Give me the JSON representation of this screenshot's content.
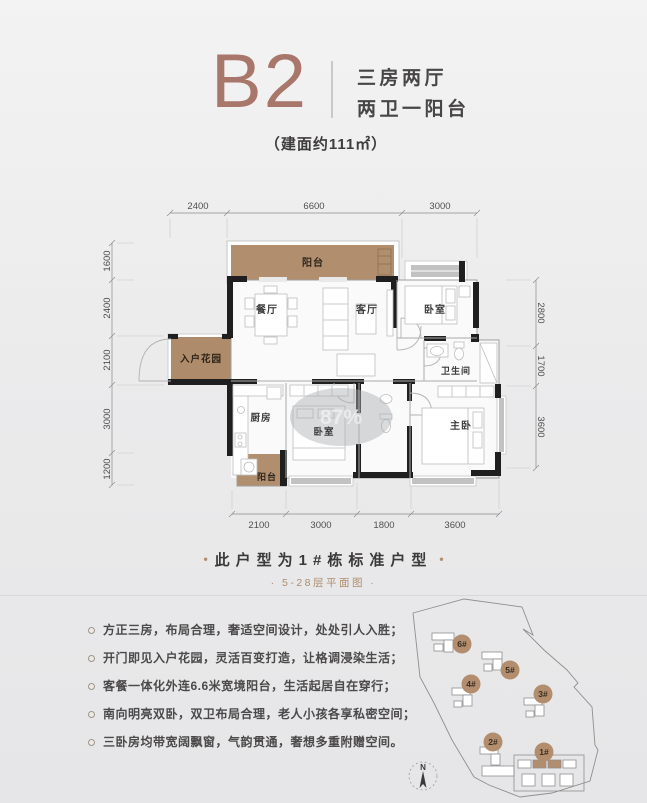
{
  "header": {
    "unit_code": "B2",
    "type_line1": "三房两厅",
    "type_line2": "两卫一阳台",
    "area_note": "（建面约111㎡）"
  },
  "floorplan": {
    "dims": {
      "top": [
        "2400",
        "6600",
        "3000"
      ],
      "left": [
        "1600",
        "2400",
        "2100",
        "3000",
        "1200"
      ],
      "right": [
        "2800",
        "1700",
        "3600"
      ],
      "bottom": [
        "2100",
        "3000",
        "1800",
        "3600"
      ]
    },
    "rooms": {
      "balcony_top": "阳台",
      "dining": "餐厅",
      "living": "客厅",
      "bedroom_top": "卧室",
      "entry_garden": "入户花园",
      "bathroom": "卫生间",
      "kitchen": "厨房",
      "bedroom_mid": "卧室",
      "master": "主卧",
      "balcony_small": "阳台"
    },
    "watermark": "87%"
  },
  "caption": {
    "deco_dot": "•",
    "title": "此户型为1#栋标准户型",
    "subtitle": "· 5-28层平面图 ·"
  },
  "features": [
    "方正三房，布局合理，奢适空间设计，处处引人入胜；",
    "开门即见入户花园，灵活百变打造，让格调浸染生活；",
    "客餐一体化外连6.6米宽境阳台，生活起居自在穿行；",
    "南向明亮双卧，双卫布局合理，老人小孩各享私密空间；",
    "三卧房均带宽阔飘窗，气韵贯通，奢想多重附赠空间。"
  ],
  "sitemap": {
    "labels": [
      "6#",
      "5#",
      "4#",
      "3#",
      "2#",
      "1#"
    ],
    "compass_n": "N"
  },
  "colors": {
    "accent_rose_brown": "#a8766a",
    "balcony_tan": "#b18e6e",
    "wall_black": "#1f1f1f",
    "background_gray": "#ebebec"
  }
}
